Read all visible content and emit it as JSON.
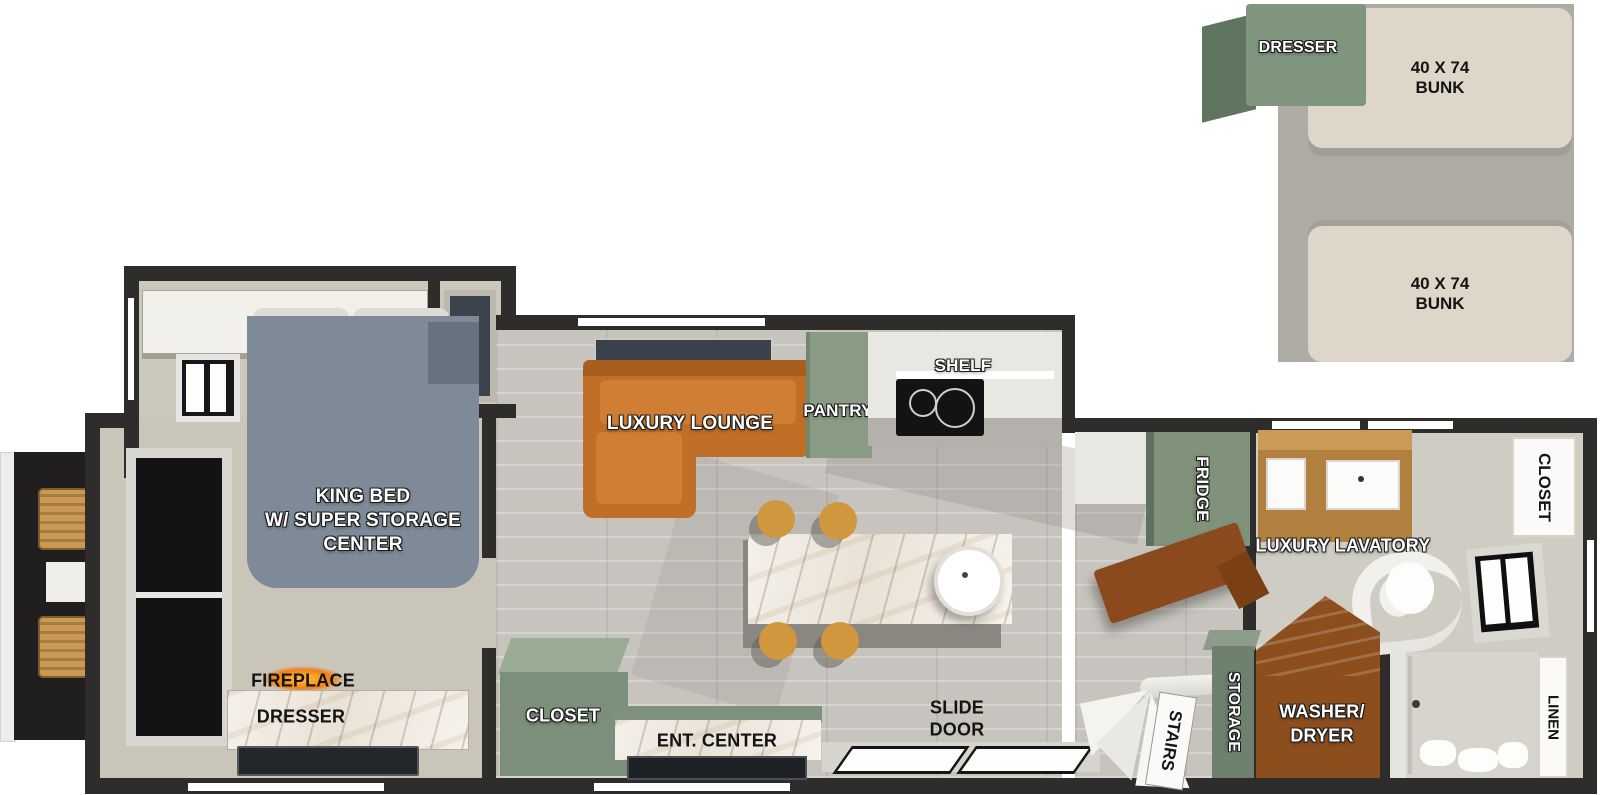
{
  "title": "Travel trailer floorplan with loft",
  "loft": {
    "dresser_label": "DRESSER",
    "bunks": [
      {
        "size": "40 X 74",
        "type": "BUNK"
      },
      {
        "size": "40 X 74",
        "type": "BUNK"
      }
    ]
  },
  "bedroom": {
    "ohc_label": "OHC",
    "bed_lines": [
      "KING BED",
      "W/ SUPER STORAGE",
      "CENTER"
    ],
    "fireplace_label": "FIREPLACE",
    "dresser_label": "DRESSER"
  },
  "living": {
    "lounge_label": "LUXURY LOUNGE",
    "pantry_label": "PANTRY",
    "shelf_label": "SHELF",
    "closet_label": "CLOSET",
    "ent_center_label": "ENT. CENTER",
    "slide_door_lines": [
      "SLIDE",
      "DOOR"
    ]
  },
  "kitchen": {
    "fridge_label": "FRIDGE"
  },
  "stairwell": {
    "stairs_label": "STAIRS",
    "storage_label": "STORAGE"
  },
  "bathroom": {
    "lavatory_label": "LUXURY LAVATORY",
    "washer_dryer_lines": [
      "WASHER/",
      "DRYER"
    ],
    "closet_label": "CLOSET",
    "linen_label": "LINEN"
  },
  "colors": {
    "wall": "#2e2d2b",
    "sage_green": "#7f957e",
    "sofa_orange": "#c06f28",
    "bunk_beige": "#ddd6c9",
    "loft_gray": "#aeaaa4",
    "stair_wood": "#8a4a1e",
    "bed_slate": "#7e8a98",
    "marble": "#f0ebe2",
    "floor": "#c7c4be"
  }
}
